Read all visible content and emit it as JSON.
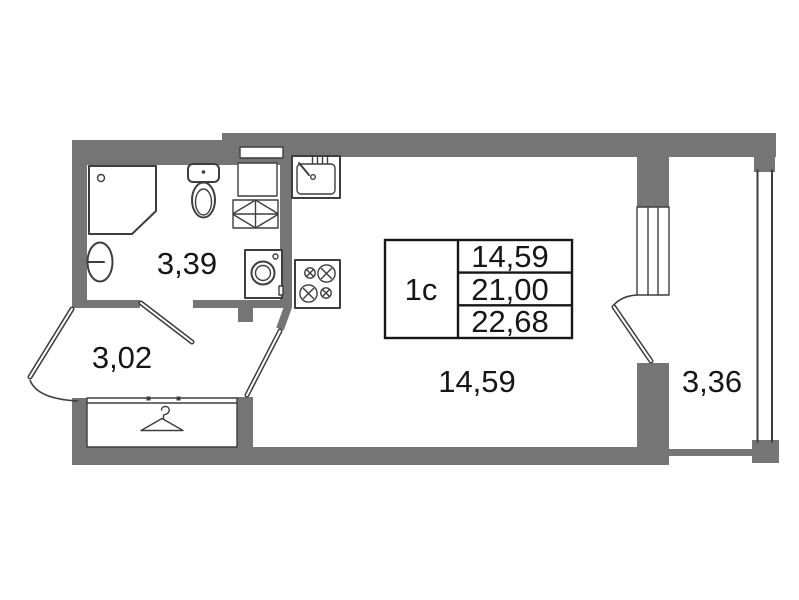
{
  "floor_plan": {
    "info_table": {
      "unit_type": "1с",
      "rows": [
        "14,59",
        "21,00",
        "22,68"
      ]
    },
    "room_labels": {
      "bathroom": "3,39",
      "hallway": "3,02",
      "living_room": "14,59",
      "balcony": "3,36"
    },
    "colors": {
      "wall": "#757575",
      "outline": "#3e3e3e",
      "table_border": "#161616",
      "text": "#161616",
      "background": "#ffffff"
    },
    "icons": {
      "shower": "chamfered-square-with-drain",
      "washbasin": "wall-oval-with-tap",
      "toilet": "tank-and-bowl",
      "vent-shelf": "grid-with-diagonals",
      "washing-machine": "square-with-drum",
      "kitchen-sink": "basin-with-faucet",
      "stove": "four-crossed-burners",
      "wardrobe-hanger": "clothes-hanger",
      "entry-door": "leaf-with-swing-arc",
      "balcony-door": "leaf-with-swing-arc",
      "window": "multi-line-frame",
      "balcony-glazing": "double-line"
    }
  }
}
